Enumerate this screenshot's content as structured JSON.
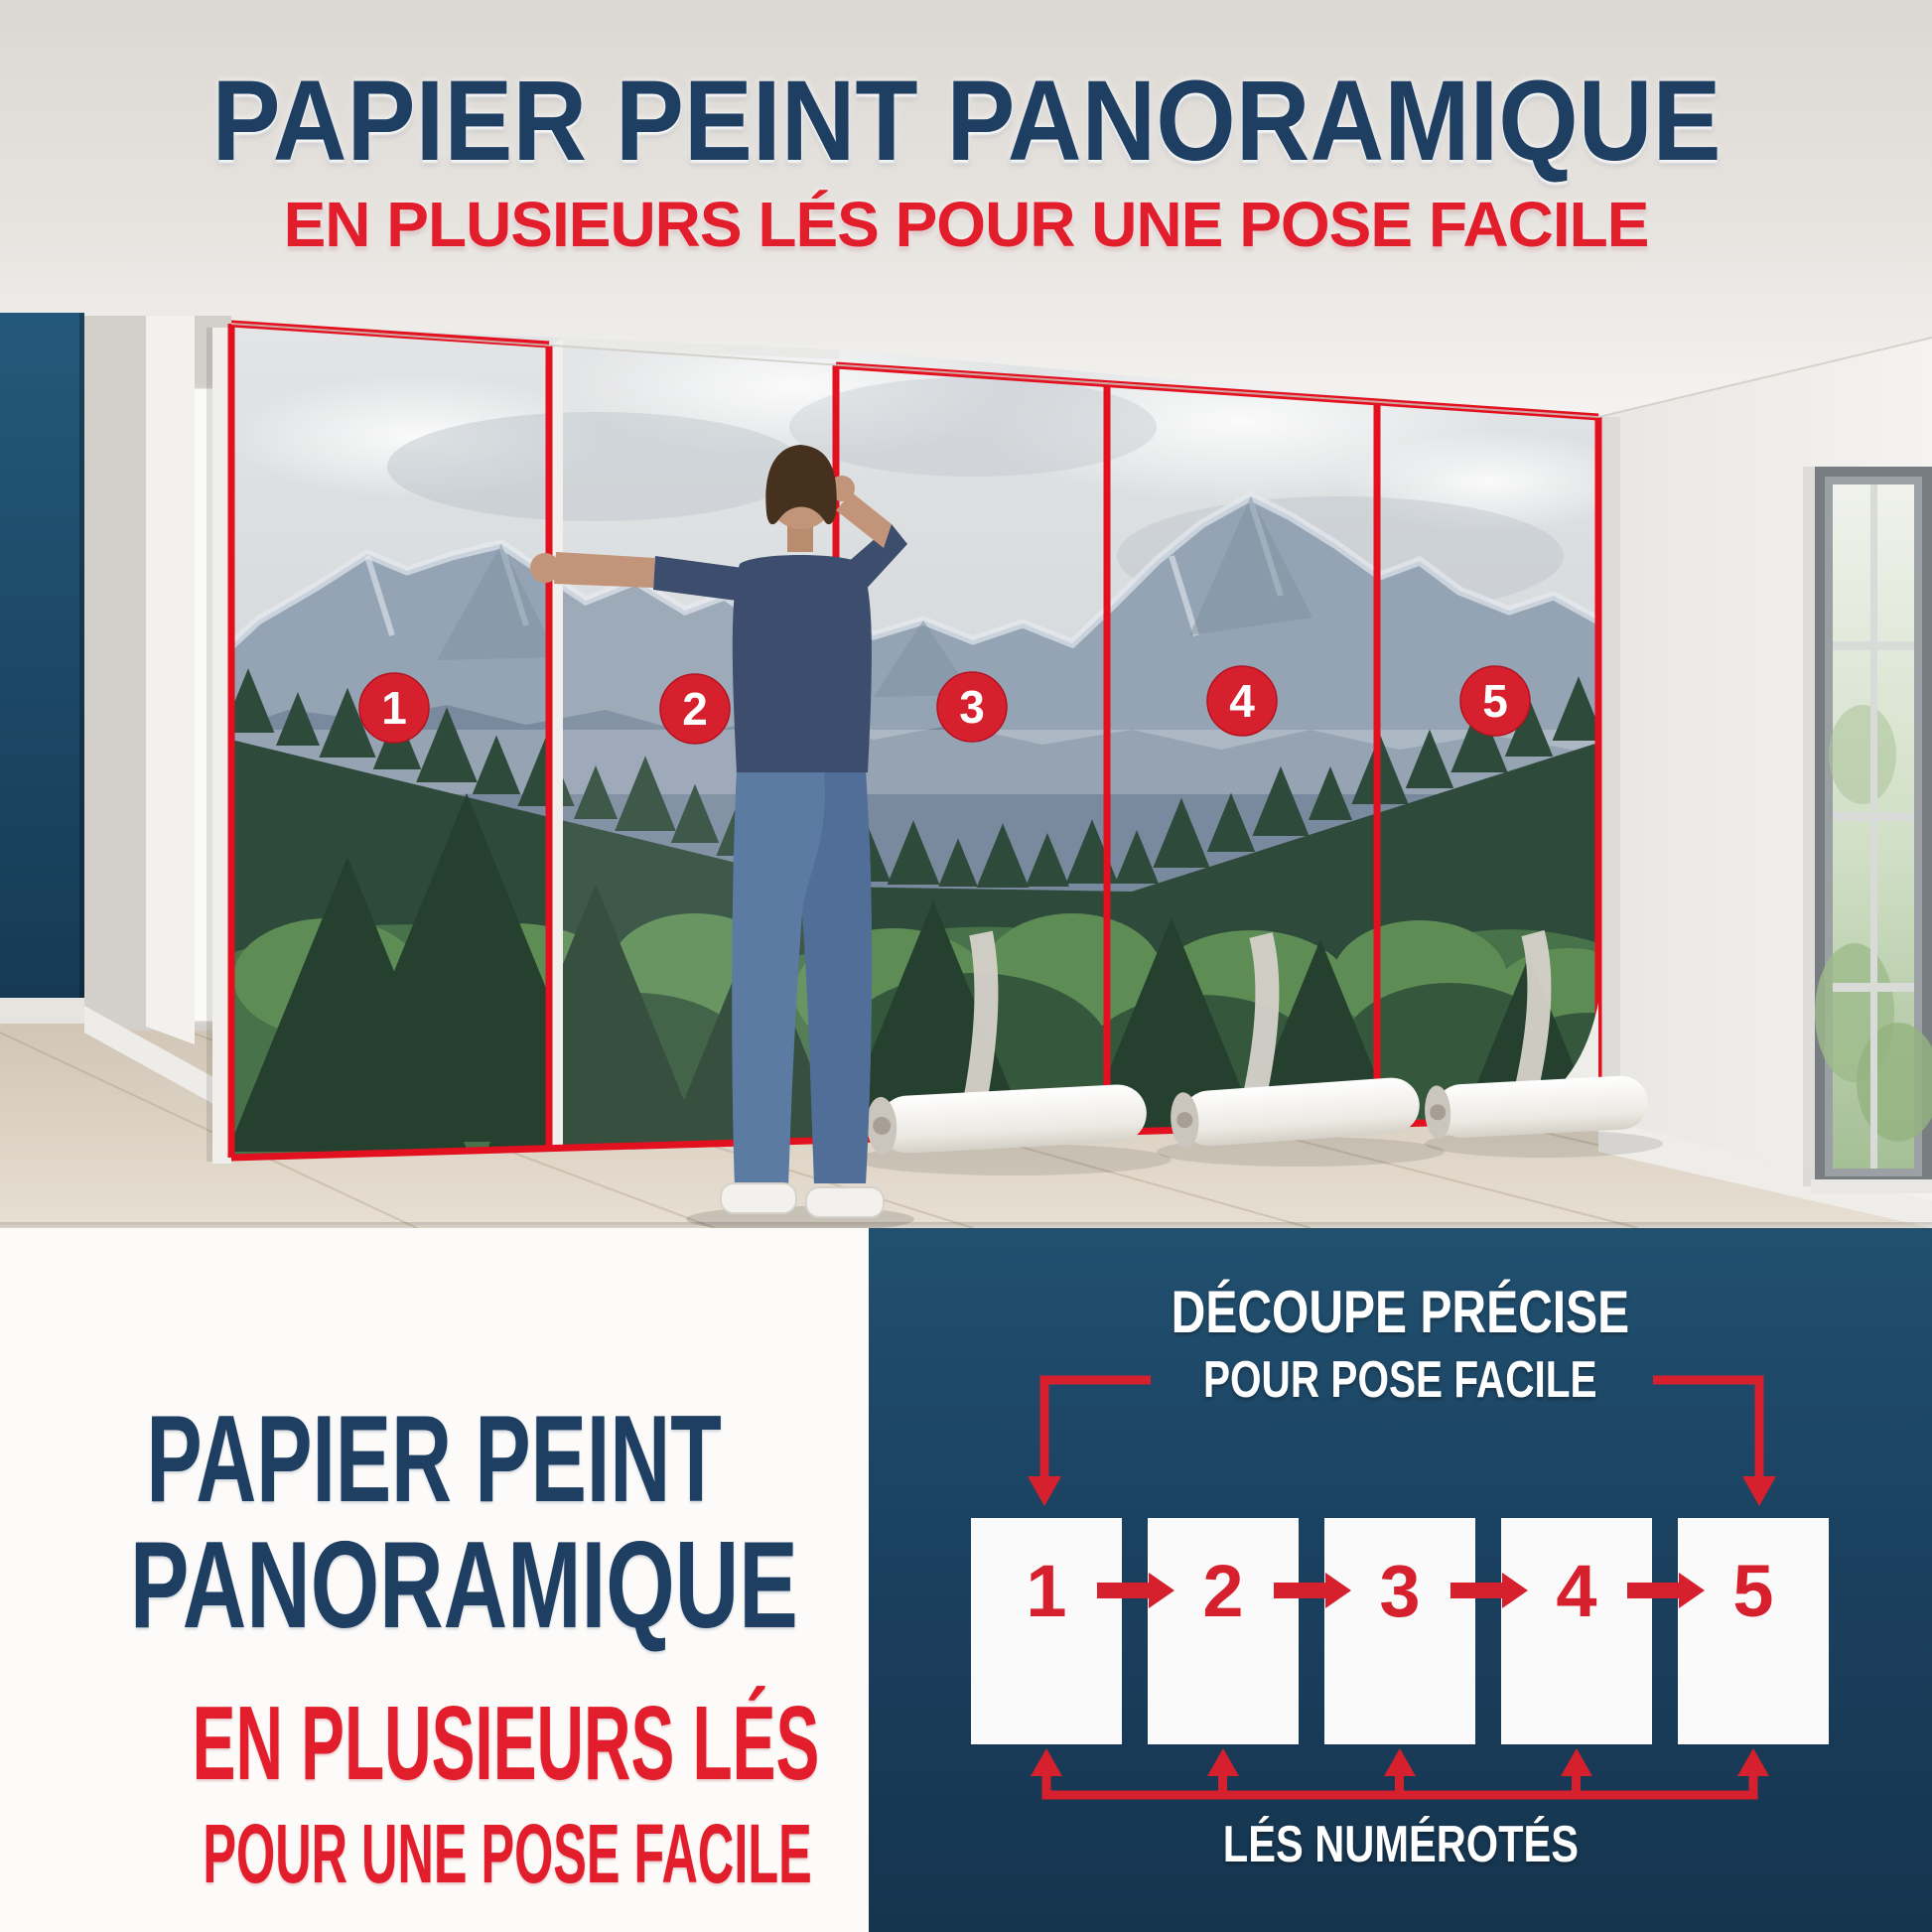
{
  "header": {
    "title": "PAPIER PEINT PANORAMIQUE",
    "subtitle": "EN PLUSIEURS LÉS POUR UNE POSE FACILE"
  },
  "photo": {
    "panels": [
      {
        "number": "1"
      },
      {
        "number": "2"
      },
      {
        "number": "3"
      },
      {
        "number": "4"
      },
      {
        "number": "5"
      }
    ]
  },
  "bottom_left": {
    "title_line1": "PAPIER PEINT",
    "title_line2": "PANORAMIQUE",
    "subtitle_line1": "EN PLUSIEURS LÉS",
    "subtitle_line2": "POUR UNE POSE FACILE"
  },
  "diagram": {
    "title_line1": "DÉCOUPE PRÉCISE",
    "title_line2": "POUR POSE FACILE",
    "strips": [
      {
        "number": "1"
      },
      {
        "number": "2"
      },
      {
        "number": "3"
      },
      {
        "number": "4"
      },
      {
        "number": "5"
      }
    ],
    "caption": "LÉS NUMÉROTÉS"
  },
  "colors": {
    "title_navy": "#1e3e62",
    "panel_navy": "#1b4060",
    "accent_red": "#e21e2c",
    "outline_red": "#e3101f",
    "badge_red": "#d6202e",
    "white": "#fcfbf9"
  }
}
